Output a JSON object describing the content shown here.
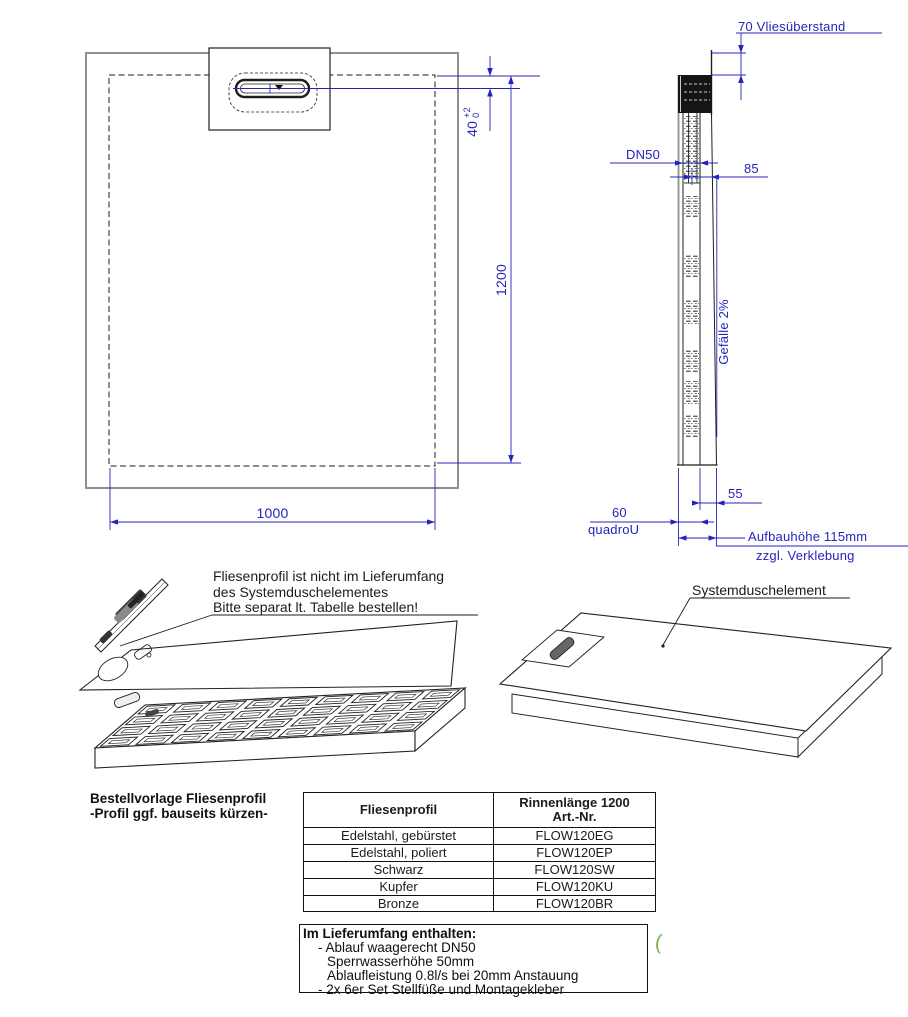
{
  "plan_view": {
    "dim_width_bottom": "1000",
    "dim_length_side": "1200",
    "dim_drain_offset": "40",
    "tol_plus": "+2",
    "tol_zero": "0"
  },
  "side_view": {
    "fleece_note": "70 Vliesüberstand",
    "drain_size": "DN50",
    "dim_center_to_top": "85",
    "slope_note": "Gefälle 2%",
    "dim_edge_height": "55",
    "dim_body_height": "60",
    "series_name": "quadroU",
    "build_height": "Aufbauhöhe 115mm",
    "build_height_note": "zzgl. Verklebung"
  },
  "exploded_note": {
    "line1": "Fliesenprofil ist nicht im Lieferumfang",
    "line2": "des Systemduschelementes",
    "line3": "Bitte separat lt. Tabelle bestellen!"
  },
  "iso_label": "Systemduschelement",
  "order": {
    "caption1": "Bestellvorlage Fliesenprofil",
    "caption2": "-Profil ggf. bauseits kürzen-",
    "header_col1": "Fliesenprofil",
    "header_col2a": "Rinnenlänge 1200",
    "header_col2b": "Art.-Nr.",
    "rows": [
      {
        "material": "Edelstahl, gebürstet",
        "art": "FLOW120EG"
      },
      {
        "material": "Edelstahl, poliert",
        "art": "FLOW120EP"
      },
      {
        "material": "Schwarz",
        "art": "FLOW120SW"
      },
      {
        "material": "Kupfer",
        "art": "FLOW120KU"
      },
      {
        "material": "Bronze",
        "art": "FLOW120BR"
      }
    ]
  },
  "scope": {
    "title": "Im Lieferumfang enthalten:",
    "item1": "- Ablauf waagerecht DN50",
    "item2": "Sperrwasserhöhe 50mm",
    "item3": "Ablaufleistung 0.8l/s bei 20mm Anstauung",
    "item4": "- 2x 6er Set Stellfüße und Montagekleber"
  },
  "stray_mark": "(",
  "colors": {
    "dimension_blue": "#2424bc",
    "drawing_black": "#1e1e1e",
    "drawing_gray": "#909090",
    "stray_green": "#7fae52"
  }
}
